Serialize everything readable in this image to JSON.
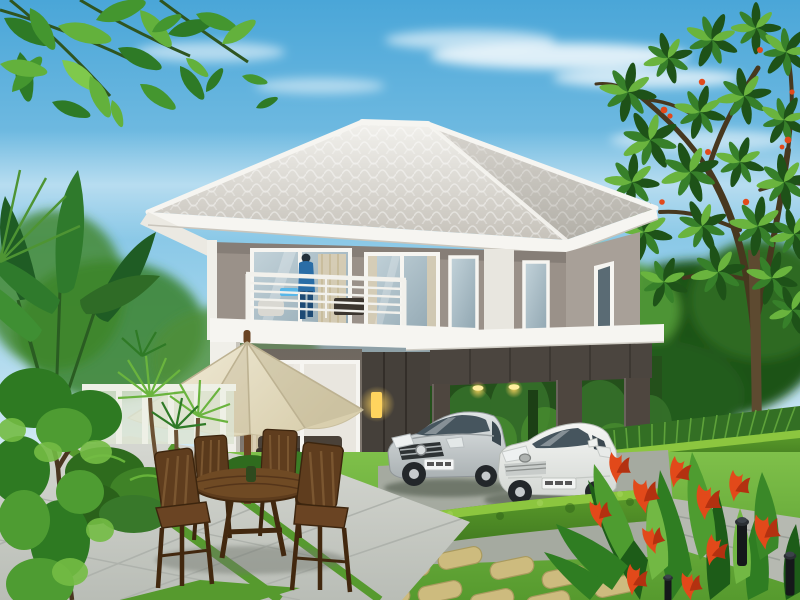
{
  "scene": {
    "type": "photograph",
    "description": "Two-story modern gray house with white hip tile roof, balcony with person, carport with two cars, garden patio with cream umbrella and wooden dining set, bright lawn with stepping stones, tropical plants and red canna flowers",
    "objects": [
      {
        "name": "sky",
        "description": "clear blue sky with thin white clouds"
      },
      {
        "name": "house",
        "description": "two-story modern house, taupe gray walls, white trim"
      },
      {
        "name": "roof",
        "description": "white concrete tile hip roof with wide eaves"
      },
      {
        "name": "balcony",
        "description": "second floor balcony with white horizontal-bar railing"
      },
      {
        "name": "person-on-balcony",
        "description": "figure in blue standing at balcony glass door"
      },
      {
        "name": "upper-sliding-door",
        "description": "large glass sliding door on second floor"
      },
      {
        "name": "upper-windows",
        "description": "two framed windows and narrow lights on second floor"
      },
      {
        "name": "ground-floor-door",
        "description": "glass sliding door showing living room interior"
      },
      {
        "name": "wall-lamp",
        "description": "warm glowing lamp on dark charcoal wall panel"
      },
      {
        "name": "carport",
        "description": "flat white roof carport with dark taupe beam and pillars"
      },
      {
        "name": "car-silver-hatchback",
        "description": "silver compact hatchback parked under carport"
      },
      {
        "name": "car-white-sedan",
        "description": "white sedan parked in driveway"
      },
      {
        "name": "patio-umbrella",
        "description": "cream market umbrella with wooden pole"
      },
      {
        "name": "dining-set",
        "description": "round wooden table with four slatted chairs"
      },
      {
        "name": "patio-pavers",
        "description": "light stone patio with diagonal grass joints"
      },
      {
        "name": "lawn",
        "description": "bright green lawn"
      },
      {
        "name": "stepping-stones",
        "description": "tan stepping stones in diagonal rows"
      },
      {
        "name": "foreground-hedge",
        "description": "low trimmed hedge running diagonally before the cars"
      },
      {
        "name": "driveway",
        "description": "gray paved driveway at right"
      },
      {
        "name": "banana-plant",
        "description": "large paddle-leaf banana / traveler palm at left"
      },
      {
        "name": "yucca-palms",
        "description": "small spiky palms beside the patio"
      },
      {
        "name": "garden-bushes",
        "description": "round trimmed shrubs"
      },
      {
        "name": "frangipani-tree",
        "description": "tree with leaf rosettes and red blossoms at top right"
      },
      {
        "name": "canna-flowers",
        "description": "red-orange canna lilies in foreground bed"
      },
      {
        "name": "garden-lamps",
        "description": "black bollard garden lights"
      },
      {
        "name": "garden-fence",
        "description": "pale fence behind left garden"
      },
      {
        "name": "overhanging-leaves",
        "description": "green leaf canopy overhanging top left corner"
      }
    ]
  },
  "palette": {
    "sky_top": "#4aa6d8",
    "sky_mid": "#93cde9",
    "sky_low": "#dceef6",
    "cloud": "#ffffff",
    "roof_light": "#f2f1ed",
    "roof_shade": "#c6c2ba",
    "roof_side": "#d8d5cf",
    "fascia": "#f6f5f1",
    "wall_upper": "#9a9189",
    "wall_shade": "#857d75",
    "wall_right": "#a8a098",
    "white_trim": "#f0efe9",
    "panel_dark": "#45403a",
    "panel_seam": "#332e29",
    "glass_hi": "#c3d3da",
    "glass_lo": "#8fa5b0",
    "glass_dark": "#5a6b74",
    "curtain": "#d9cdb2",
    "interior": "#e9e6df",
    "sofa": "#3b332b",
    "lawn_hi": "#7fc04a",
    "lawn_lo": "#569a2e",
    "hedge_hi": "#8cc63f",
    "hedge_mid": "#5d9e2c",
    "hedge_dark": "#2f6318",
    "foliage_dark": "#1e5218",
    "foliage_mid": "#37802a",
    "foliage_hi": "#6ab43e",
    "foliage_pale": "#8ed257",
    "paver_hi": "#d6d8d2",
    "paver_lo": "#b9bdb6",
    "stone": "#cdbb7e",
    "stone_edge": "#a99a5e",
    "umbrella_hi": "#f4efdd",
    "umbrella_lo": "#d9cfae",
    "wood": "#6a4423",
    "wood_dark": "#452a10",
    "car_silver_hi": "#e1e5e6",
    "car_silver_lo": "#aab1b3",
    "car_white_hi": "#f5f6f4",
    "car_white_lo": "#d4d8d4",
    "tire": "#23272a",
    "car_glass": "#46555e",
    "drive": "#b6b9b1",
    "pave_back": "#a5aaa0",
    "flower_red": "#e2491a",
    "flower_deep": "#b33110",
    "lamp_glow": "#ffd45e",
    "trunk": "#5d4a30",
    "branch": "#47381f",
    "figure_blue": "#2a6da6",
    "figure_dark": "#1d4a74",
    "fence": "#dde4d2",
    "fence_post": "#eef0e6"
  }
}
